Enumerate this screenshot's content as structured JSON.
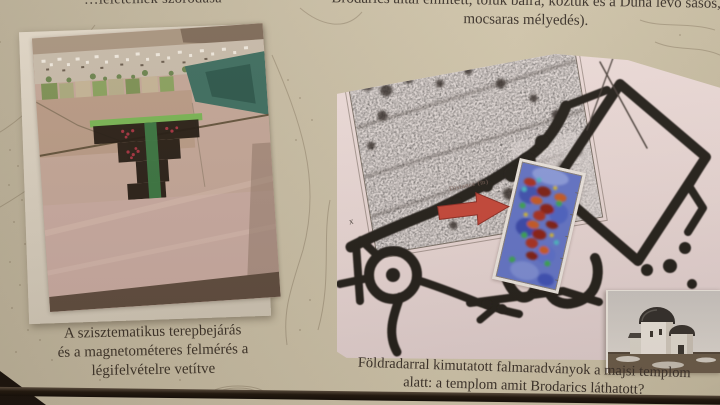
{
  "slide": {
    "top_left_fragment": "…leleteinek szóródása",
    "top_right_note": {
      "line1": "Brodarics által említett, tőlük balra, köztük és a Duna",
      "line2": "lévő sásos, mocsaras mélyedés)."
    },
    "left_figure": {
      "caption": {
        "line1": "A szisztematikus terepbejárás",
        "line2": "és a magnetométeres felmérés a",
        "line3": "légifelvételre vetítve"
      }
    },
    "right_figure": {
      "axis_origin_label": "x",
      "slice_annotation": "Distance (m)",
      "caption": {
        "line1": "Földradarral kimutatott falmaradványok a majsi templom",
        "line2": "alatt: a templom amit Brodarics láthatott?"
      }
    },
    "colors": {
      "map_background": "#c6bba2",
      "text": "#3b322a",
      "panel_background": "#e6d6d3",
      "wall_ink": "#26211d",
      "arrow_red": "#c4483a",
      "heatmap_blue": "#6474c4",
      "heatmap_red": "#a73320",
      "screen_bezel": "#1d150e"
    }
  }
}
